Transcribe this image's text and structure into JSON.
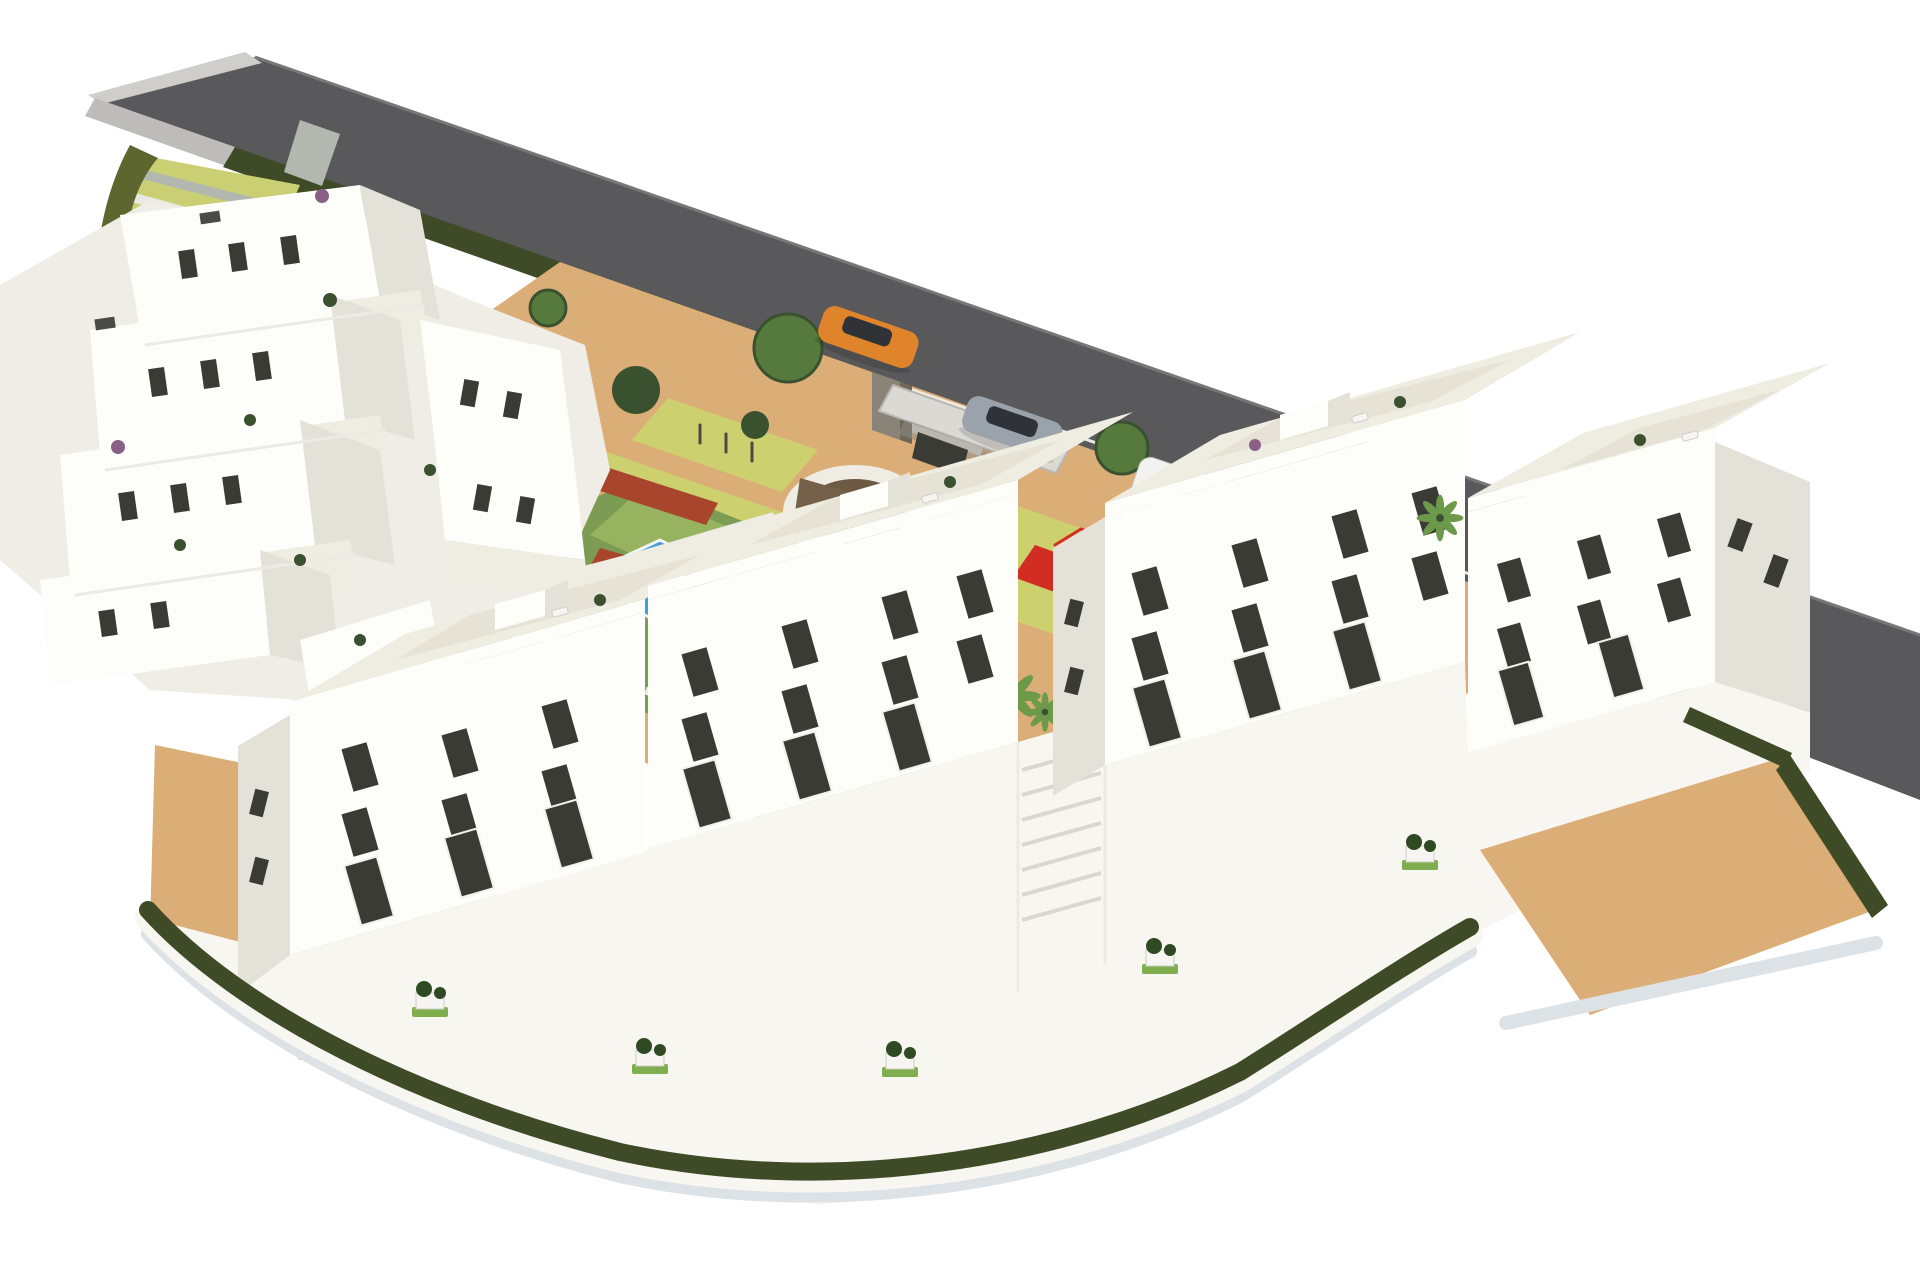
{
  "image": {
    "kind": "3D architectural rendering",
    "subject": "Aerial view of a white residential apartment complex with terraced hillside apartments, landscaped communal garden, swimming pools, children's playground, entrance canopy, perimeter road with cars and hedged boundary walls",
    "width_px": 1920,
    "height_px": 1280
  },
  "palette": {
    "background": "#ffffff",
    "road": "#59595b",
    "road_line": "#77777a",
    "curb_light": "#cfcecb",
    "sidewalk": "#bdbcb8",
    "hedge_dark": "#3e4b26",
    "hedge_olive": "#5e662f",
    "stairs_base": "#c9cf72",
    "stairs_step": "#b2b8b0",
    "stairs_white": "#e8e9e3",
    "sand": "#dcae77",
    "sand_shadow": "#b79b7c",
    "path_yellow": "#cdd06e",
    "path_white": "#efece3",
    "grass": "#7d9c53",
    "grass_light": "#97b35f",
    "pool_blue": "#3f9fd6",
    "pool_light": "#82c8e8",
    "deck_tan": "#e7d2a6",
    "red_flowers": "#a8452c",
    "soil_dark": "#6d5a42",
    "feature_wall": "#75614a",
    "feature_wall_dark": "#57452f",
    "shrub_violet": "#4b4c5e",
    "building_white": "#fdfdfa",
    "building_shade": "#efede5",
    "building_side": "#e4e1d8",
    "window_dark": "#3b3b36",
    "window_glass": "#93a0a6",
    "roof_tile": "#efece2",
    "roof_tile_light": "#e6e2d6",
    "wall_white": "#f7f6f1",
    "canopy": "#dbd9d3",
    "canopy_shadow": "#8d8d89",
    "stone_pillar": "#8a8377",
    "stone_dark": "#6e6757",
    "car_orange": "#e0842b",
    "car_silver": "#9aa3ab",
    "car_white": "#f2f2f0",
    "car_glass": "#2f3338",
    "shadow_soft": "#dde2e7",
    "tree_green": "#567a3d",
    "tree_dark": "#3a5130",
    "palm_green": "#6d9a4a",
    "trunk_brown": "#8a6b4a",
    "plant_green": "#7fae4e",
    "planter_plant": "#2f4a22",
    "purple_plant": "#8a5f86",
    "lounger_white": "#f6f5f1",
    "equip_dark": "#4a4a42",
    "play_red": "#d22d22",
    "play_green": "#59b33a"
  },
  "scene": {
    "road": {
      "surface": "asphalt",
      "cars": [
        {
          "id": "orange-car",
          "body": "#e0842b"
        },
        {
          "id": "silver-car",
          "body": "#9aa3ab"
        },
        {
          "id": "white-suv",
          "body": "#f2f2f0"
        }
      ]
    },
    "amenities": [
      "terraced hillside apartments",
      "front apartment blocks",
      "communal garden",
      "main swimming pool",
      "small pool",
      "sun deck with loungers",
      "circular feature plaza",
      "children playground",
      "outdoor fitness area",
      "entrance canopy",
      "perimeter hedge",
      "landscaped access stairs"
    ],
    "counts": {
      "front_blocks": 4,
      "cars": 3,
      "pools": 2
    }
  }
}
